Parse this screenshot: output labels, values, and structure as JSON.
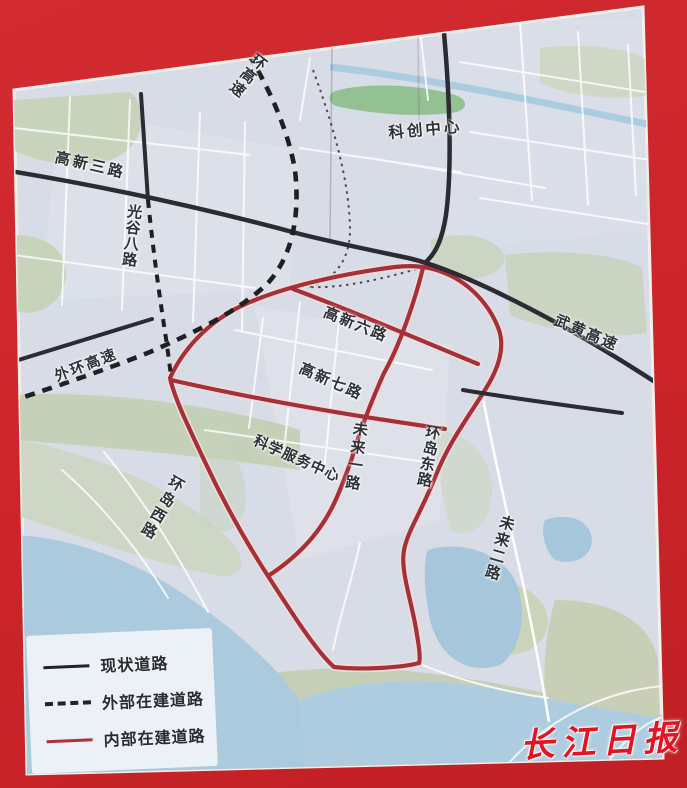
{
  "frame": {
    "background_color": "#cb2830"
  },
  "map": {
    "base_color": "#d8dce6",
    "labels": {
      "huan_gaosu": {
        "text": "环高速"
      },
      "gaoxin_3": {
        "text": "高新三路"
      },
      "guanggu_8": {
        "text": "光谷八路"
      },
      "kechuang_center": {
        "text": "科创中心"
      },
      "wuhuang_gaosu": {
        "text": "武黄高速"
      },
      "waihuan_gaosu": {
        "text": "外环高速"
      },
      "gaoxin_6": {
        "text": "高新六路"
      },
      "gaoxin_7": {
        "text": "高新七路"
      },
      "kexue_fuwu_center": {
        "text": "科学服务中心"
      },
      "weilai_1": {
        "text": "未来一路"
      },
      "huandao_east": {
        "text": "环岛东路"
      },
      "huandao_west": {
        "text": "环岛西路"
      },
      "weilai_2": {
        "text": "未来二路"
      }
    },
    "legend": {
      "items": [
        {
          "style": "solid-black",
          "label": "现状道路"
        },
        {
          "style": "dashed-black",
          "label": "外部在建道路"
        },
        {
          "style": "solid-red",
          "label": "内部在建道路"
        }
      ]
    },
    "watermark": {
      "text": "长江日报"
    },
    "colors": {
      "existing_road": "#2b2b31",
      "external_under_construction": "#1f1f24",
      "internal_under_construction": "#a5303a",
      "water": "#a6c7db",
      "park_green": "#93c193",
      "land_green": "#c7d3bb"
    }
  }
}
